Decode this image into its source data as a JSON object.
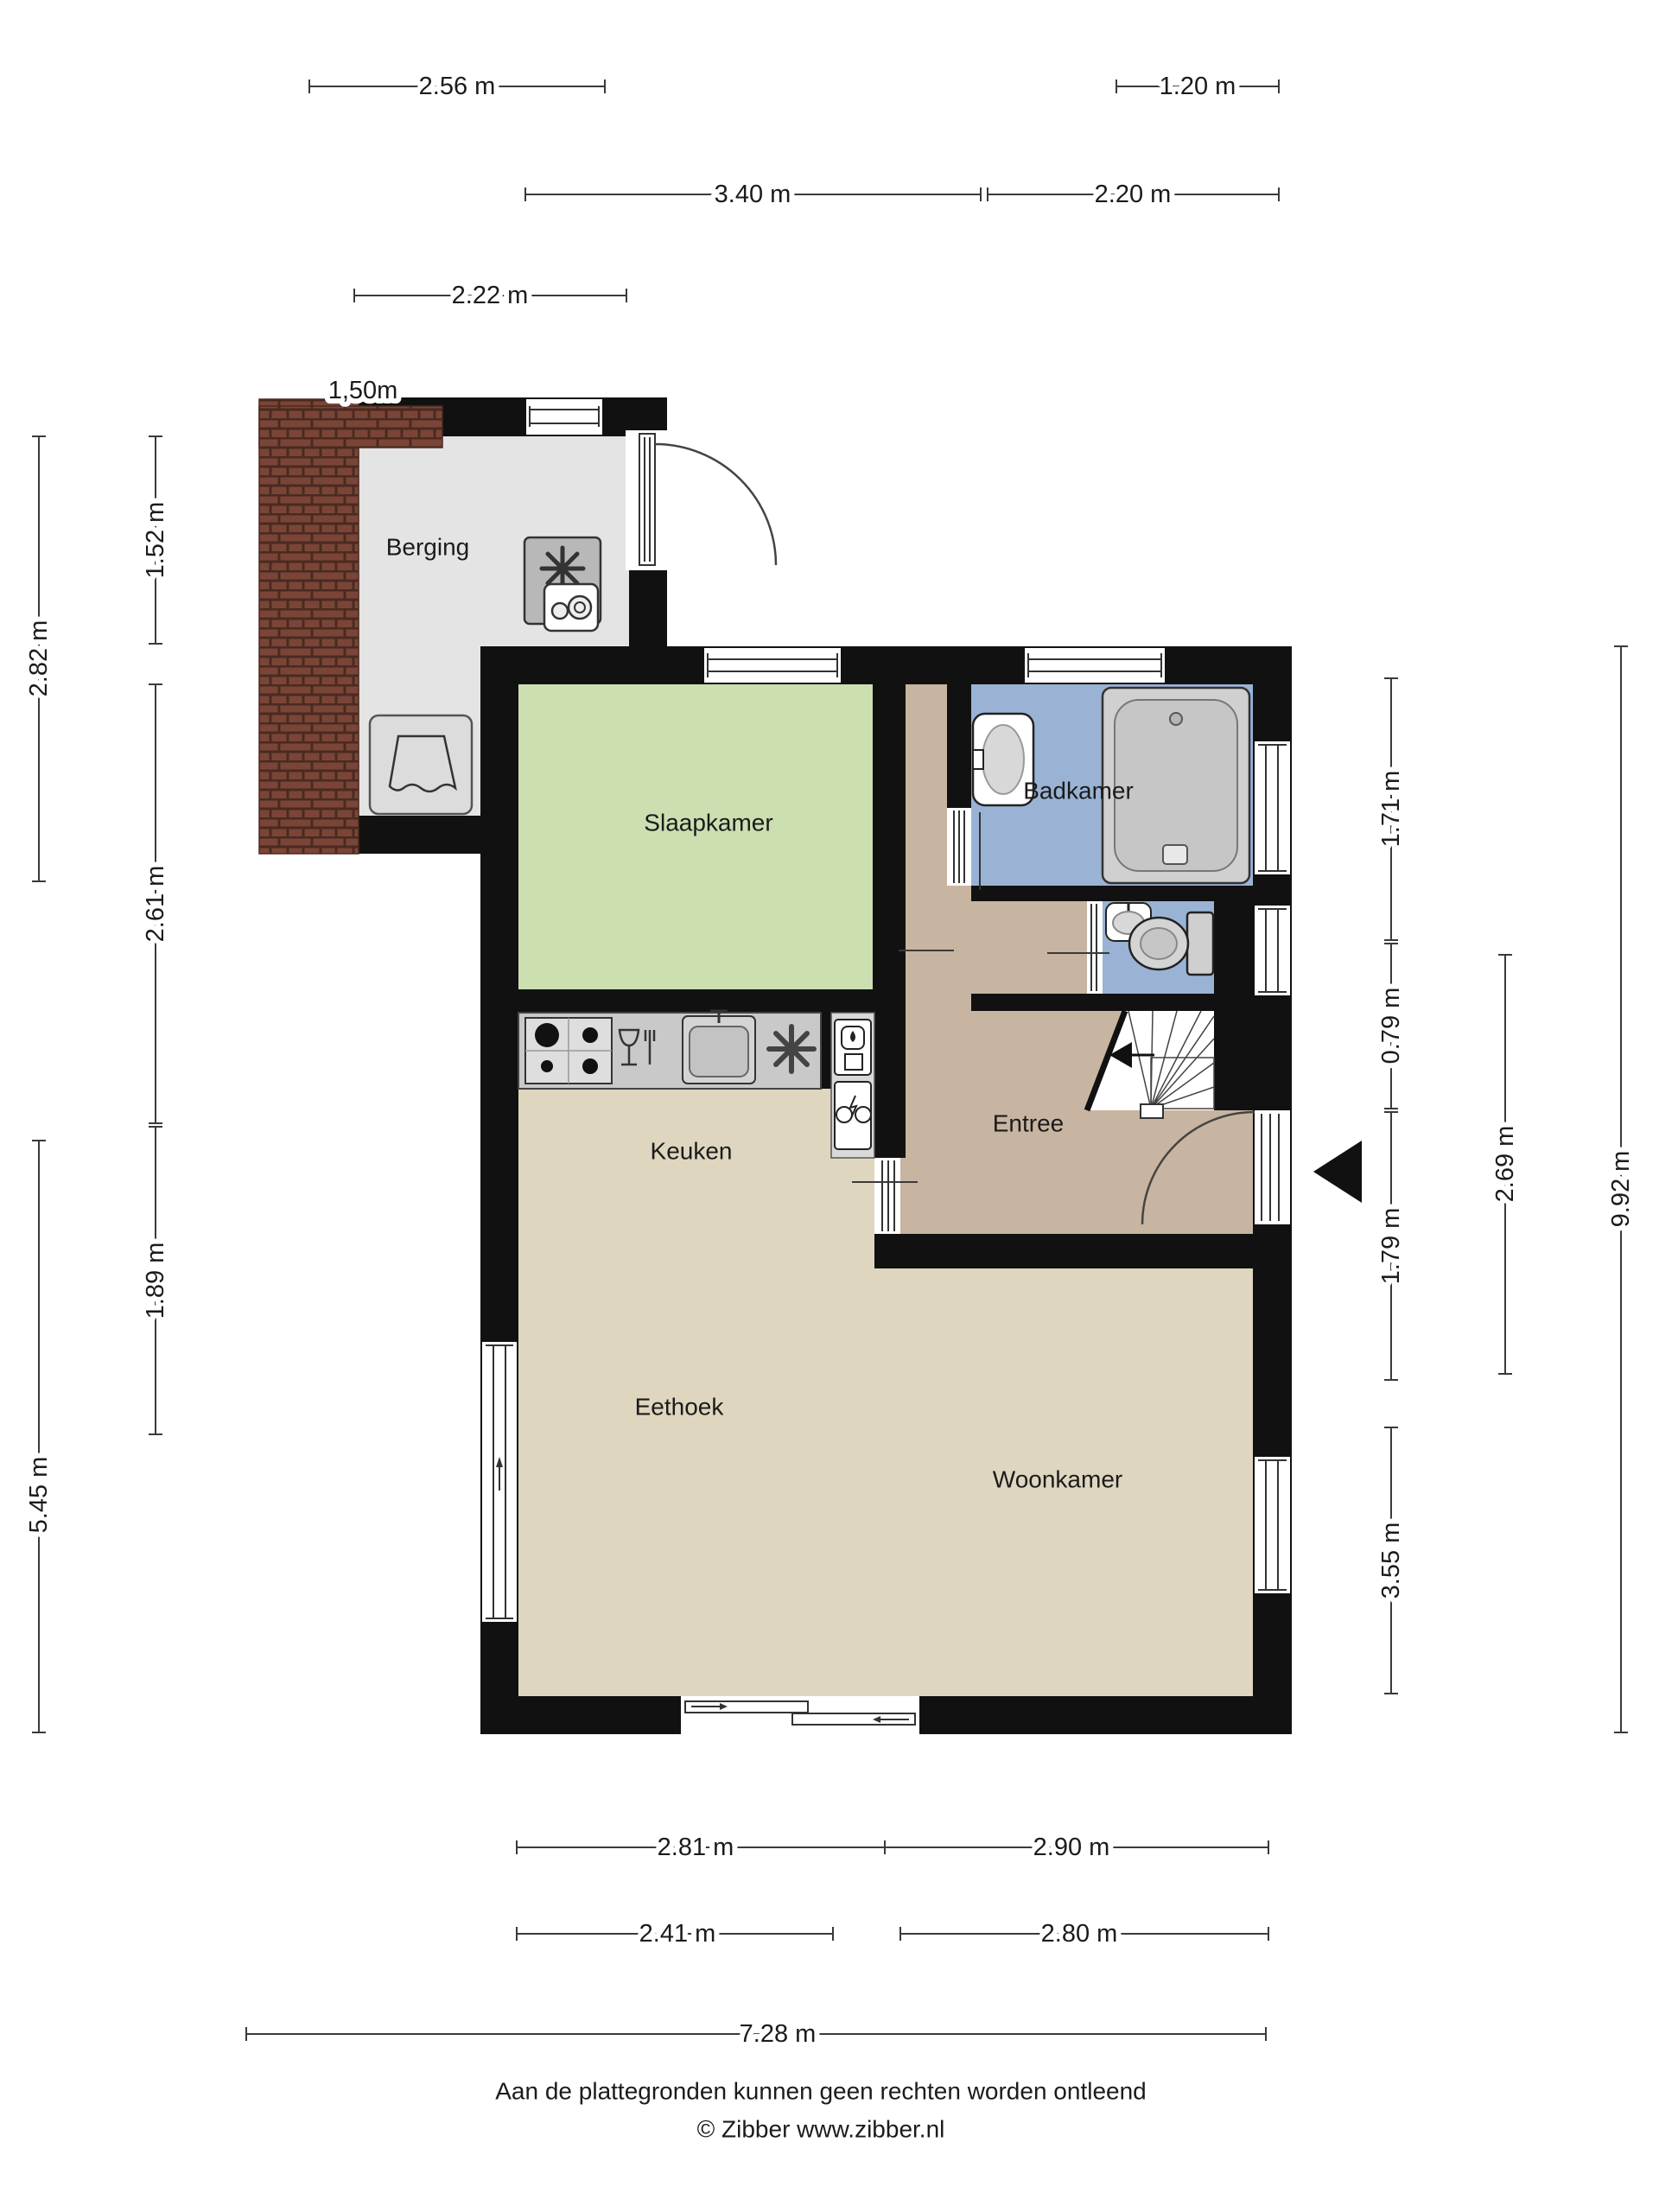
{
  "plan": {
    "type": "floorplan",
    "floor": "begane grond",
    "rooms": {
      "berging": "Berging",
      "slaapkamer": "Slaapkamer",
      "badkamer": "Badkamer",
      "entree": "Entree",
      "keuken": "Keuken",
      "eethoek": "Eethoek",
      "woonkamer": "Woonkamer"
    },
    "dims": {
      "t256": "2.56 m",
      "t120": "1.20 m",
      "t340": "3.40 m",
      "t220": "2.20 m",
      "t222": "2.22 m",
      "n150": "1,50m",
      "l282": "2.82 m",
      "l152": "1.52 m",
      "l261": "2.61 m",
      "l189": "1.89 m",
      "l545": "5.45 m",
      "r171": "1.71 m",
      "r079": "0.79 m",
      "r179": "1.79 m",
      "r355": "3.55 m",
      "r269": "2.69 m",
      "r992": "9.92 m",
      "b281": "2.81 m",
      "b290": "2.90 m",
      "b241": "2.41 m",
      "b280": "2.80 m",
      "b728": "7.28 m"
    },
    "footer": {
      "disclaimer": "Aan de plattegronden kunnen geen rechten worden ontleend",
      "copyright": "© Zibber www.zibber.nl"
    },
    "colors": {
      "wall": "#111111",
      "slaapkamer": "#cbdfb1",
      "badkamer": "#9ab3d5",
      "toilet": "#9ab3d5",
      "entree": "#c7b5a1",
      "living": "#ded6bf",
      "berging": "#e4e4e4",
      "counter": "#c9c9c9",
      "niche": "#d9d9d9",
      "brick": "#7a4536",
      "brickline": "#4a2a22",
      "fixture": "#d0d0d0"
    }
  }
}
